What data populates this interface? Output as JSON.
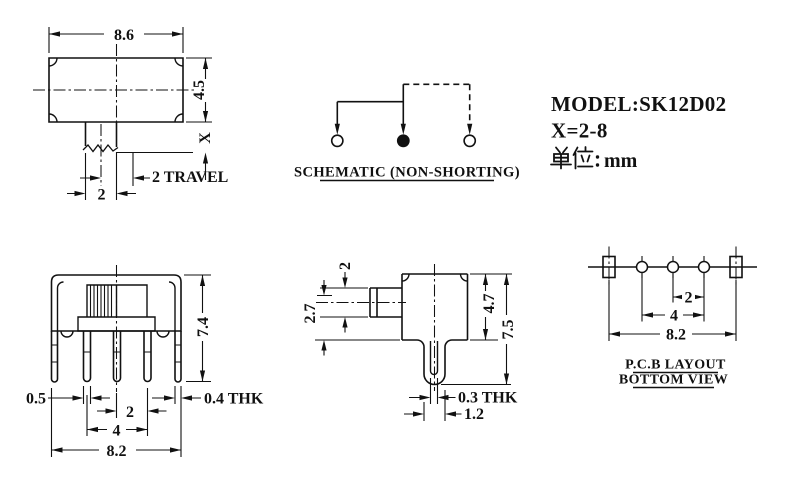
{
  "colors": {
    "ink": "#111111",
    "paper": "#ffffff"
  },
  "title_block": {
    "model": "MODEL:SK12D02",
    "x_range": "X=2-8",
    "units_prefix": "单位：",
    "units_value": "mm"
  },
  "front_view": {
    "dim_width": "8.6",
    "dim_height": "4.5",
    "dim_stem": "X",
    "dim_travel": "2 TRAVEL",
    "dim_knob": "2"
  },
  "schematic": {
    "label": "SCHEMATIC (NON-SHORTING)"
  },
  "side_view_front": {
    "dim_height": "7.4",
    "dim_pin_width": "0.5",
    "dim_pitch": "2",
    "dim_span": "4",
    "dim_overall": "8.2",
    "dim_bracket": "0.4 THK"
  },
  "side_view_right": {
    "dim_knob_width": "2",
    "dim_knob_offset": "2.7",
    "dim_body": "4.7",
    "dim_total": "7.5",
    "dim_thk": "0.3 THK",
    "dim_pin": "1.2"
  },
  "pcb_layout": {
    "label_line1": "P.C.B LAYOUT",
    "label_line2": "BOTTOM VIEW",
    "dim_pitch": "2",
    "dim_span": "4",
    "dim_overall": "8.2"
  }
}
